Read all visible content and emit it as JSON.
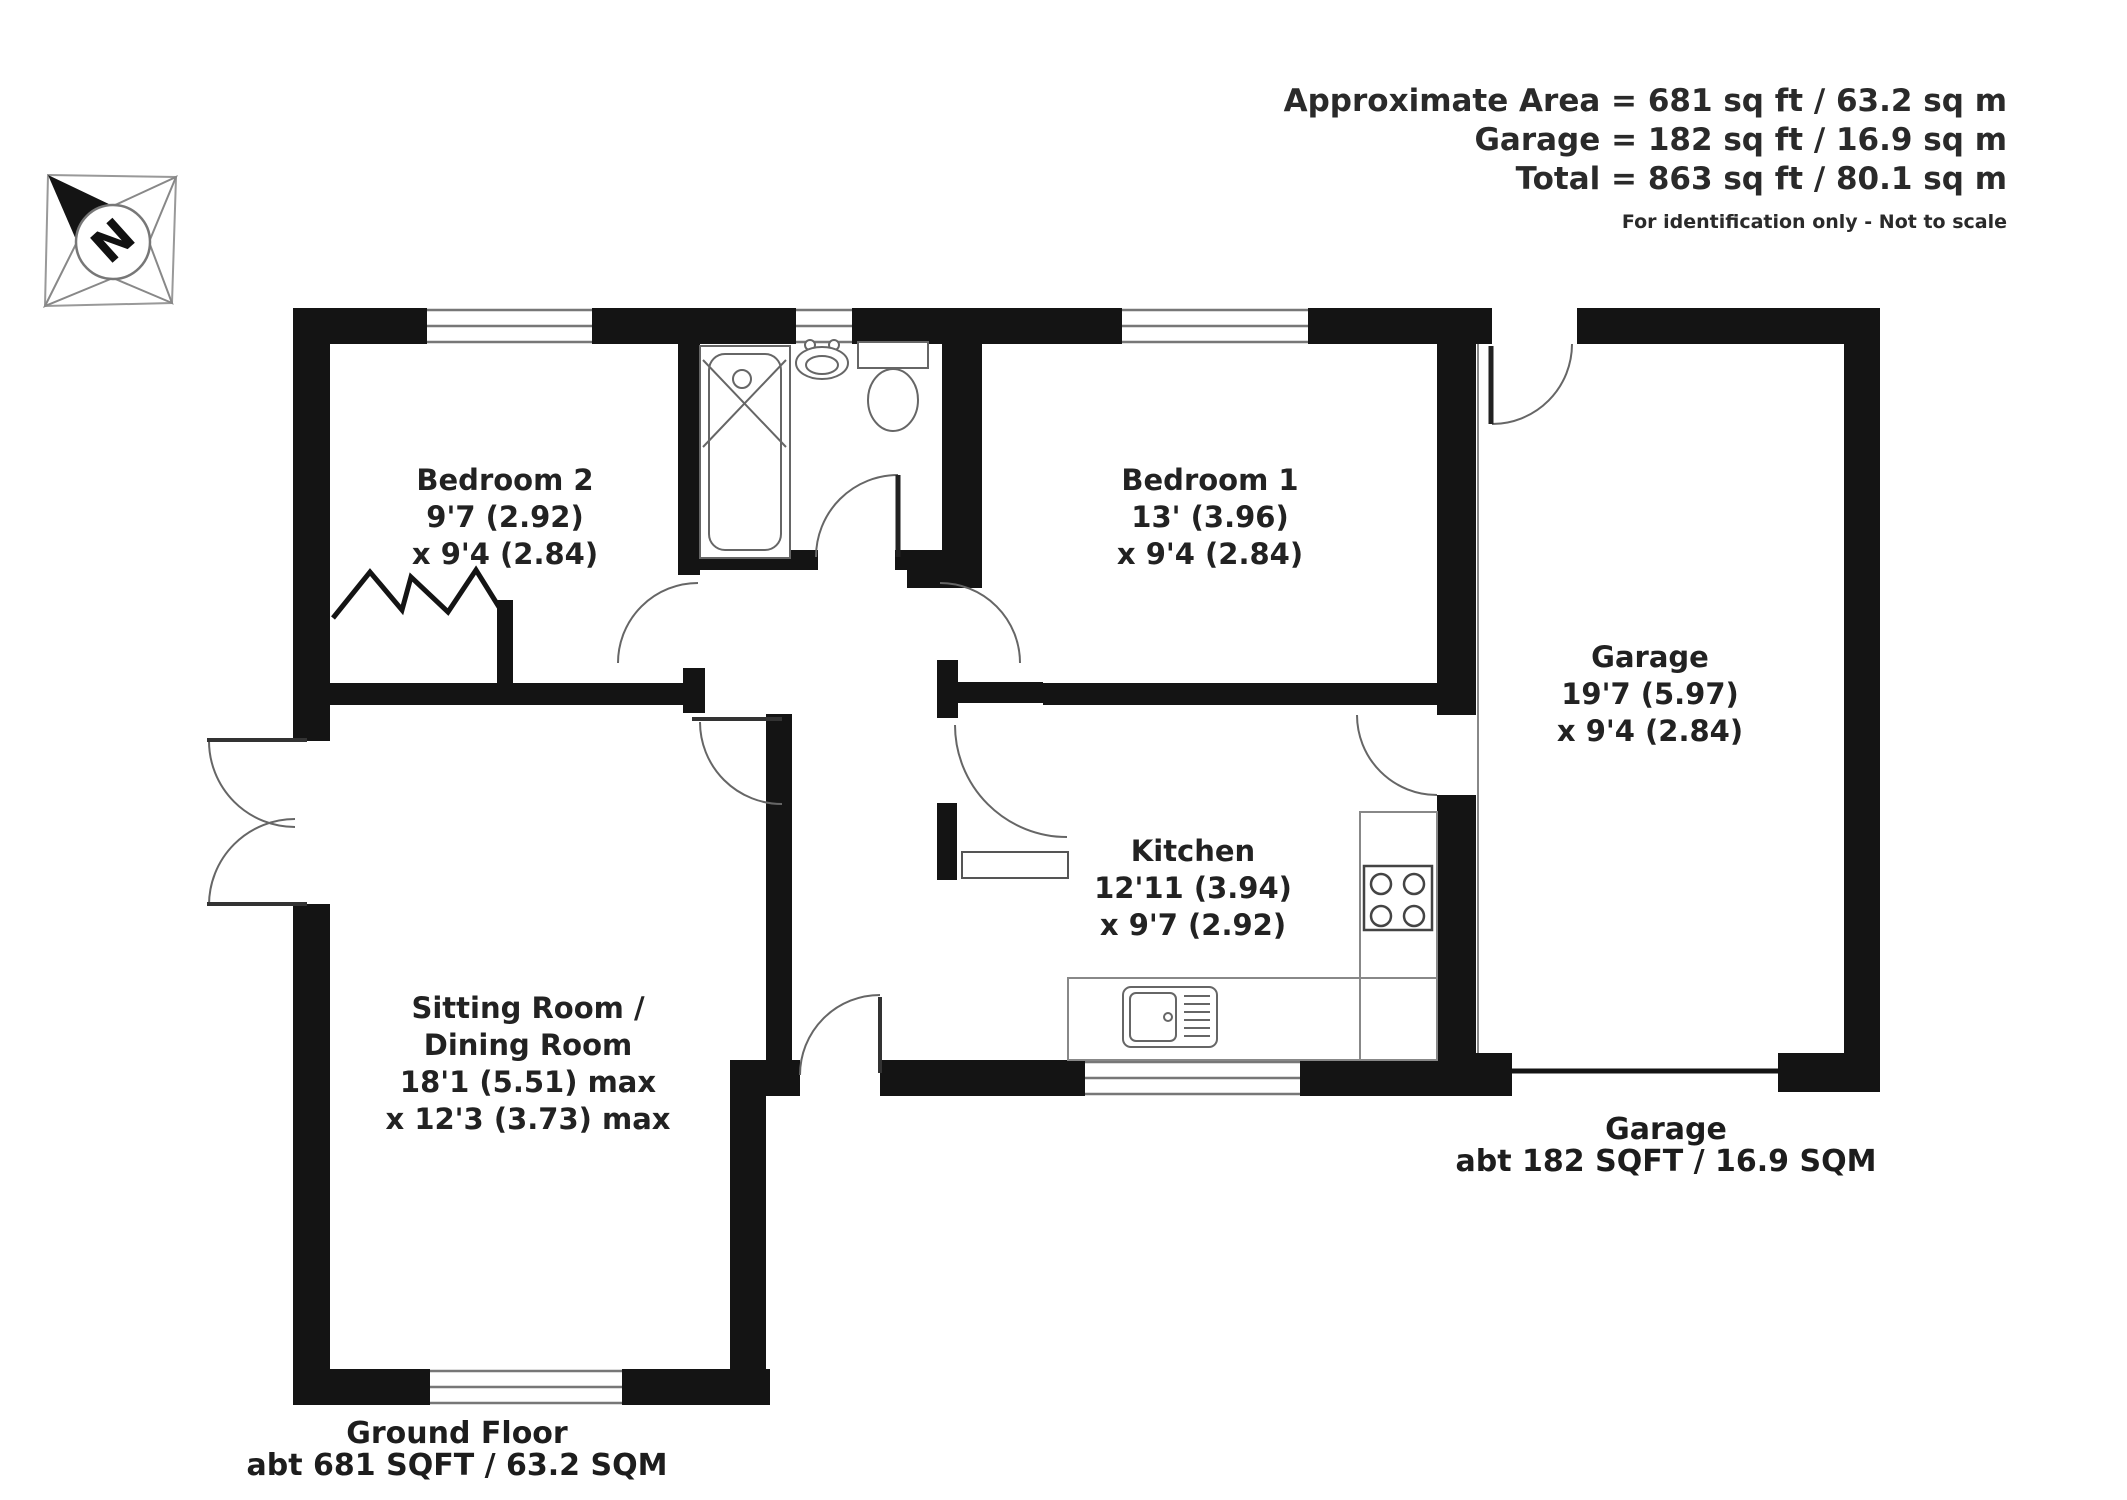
{
  "header": {
    "area_lines": [
      "Approximate Area = 681 sq ft / 63.2 sq m",
      "Garage = 182 sq ft / 16.9 sq m",
      "Total = 863 sq ft / 80.1 sq m"
    ],
    "disclaimer": "For identification only - Not to scale"
  },
  "compass": {
    "label": "N"
  },
  "rooms": [
    {
      "id": "bedroom2",
      "lines": [
        "Bedroom 2",
        "9'7 (2.92)",
        "x 9'4 (2.84)"
      ]
    },
    {
      "id": "bedroom1",
      "lines": [
        "Bedroom 1",
        "13' (3.96)",
        "x 9'4 (2.84)"
      ]
    },
    {
      "id": "garage",
      "lines": [
        "Garage",
        "19'7 (5.97)",
        "x 9'4 (2.84)"
      ]
    },
    {
      "id": "kitchen",
      "lines": [
        "Kitchen",
        "12'11 (3.94)",
        "x 9'7 (2.92)"
      ]
    },
    {
      "id": "sitting",
      "lines": [
        "Sitting Room /",
        "Dining Room",
        "18'1 (5.51) max",
        "x 12'3 (3.73) max"
      ]
    }
  ],
  "footer": {
    "ground_floor": {
      "title": "Ground Floor",
      "area": "abt 681 SQFT / 63.2 SQM"
    },
    "garage": {
      "title": "Garage",
      "area": "abt 182 SQFT / 16.9 SQM"
    }
  },
  "colors": {
    "wall": "#141414",
    "line": "#666666",
    "text": "#222222",
    "background": "#ffffff"
  }
}
